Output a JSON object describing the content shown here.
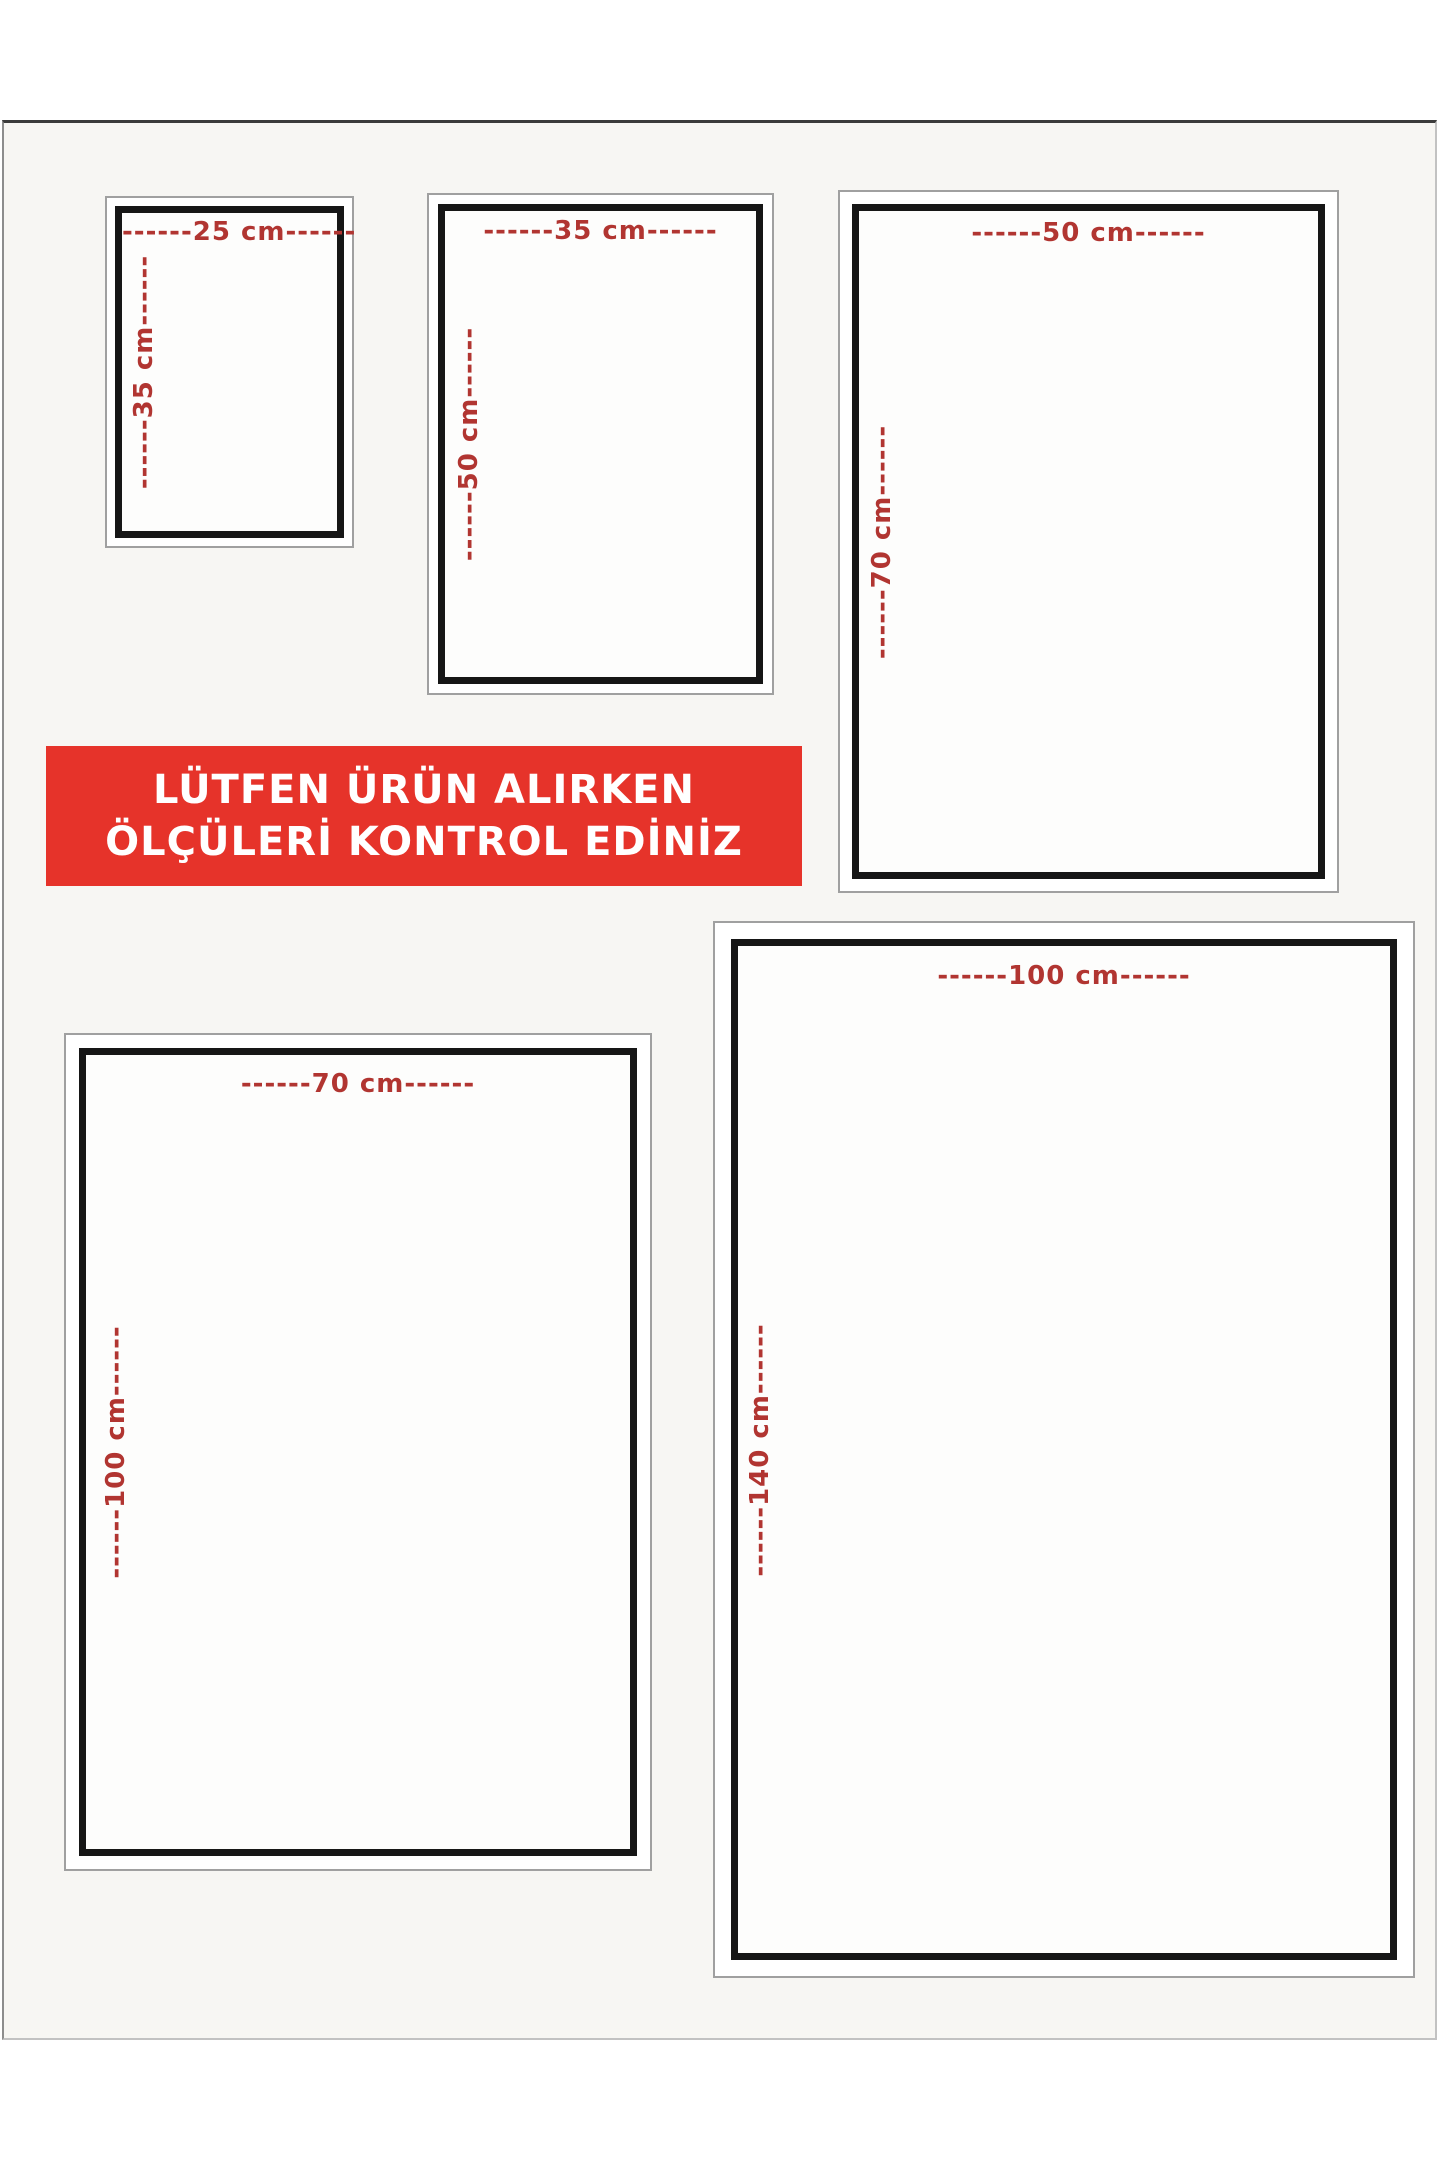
{
  "notice_banner": {
    "line1": "LÜTFEN ÜRÜN ALIRKEN",
    "line2": "ÖLÇÜLERİ KONTROL EDİNİZ"
  },
  "sizes": [
    {
      "name": "25x35 cm",
      "width_label": "------25 cm------",
      "height_label": "------35 cm------"
    },
    {
      "name": "35x50 cm",
      "width_label": "------35 cm------",
      "height_label": "------50 cm------"
    },
    {
      "name": "50x70 cm",
      "width_label": "------50 cm------",
      "height_label": "------70 cm------"
    },
    {
      "name": "70x100 cm",
      "width_label": "------70 cm------",
      "height_label": "------100 cm------"
    },
    {
      "name": "100x140 cm",
      "width_label": "------100 cm------",
      "height_label": "------140 cm------"
    }
  ],
  "colors": {
    "banner_red": "#e6332a",
    "label_red": "#b13531",
    "frame_black": "#161616",
    "frame_gray": "#a0a0a0",
    "canvas_bg": "#f7f6f3",
    "margin_bg": "#ffffff"
  }
}
